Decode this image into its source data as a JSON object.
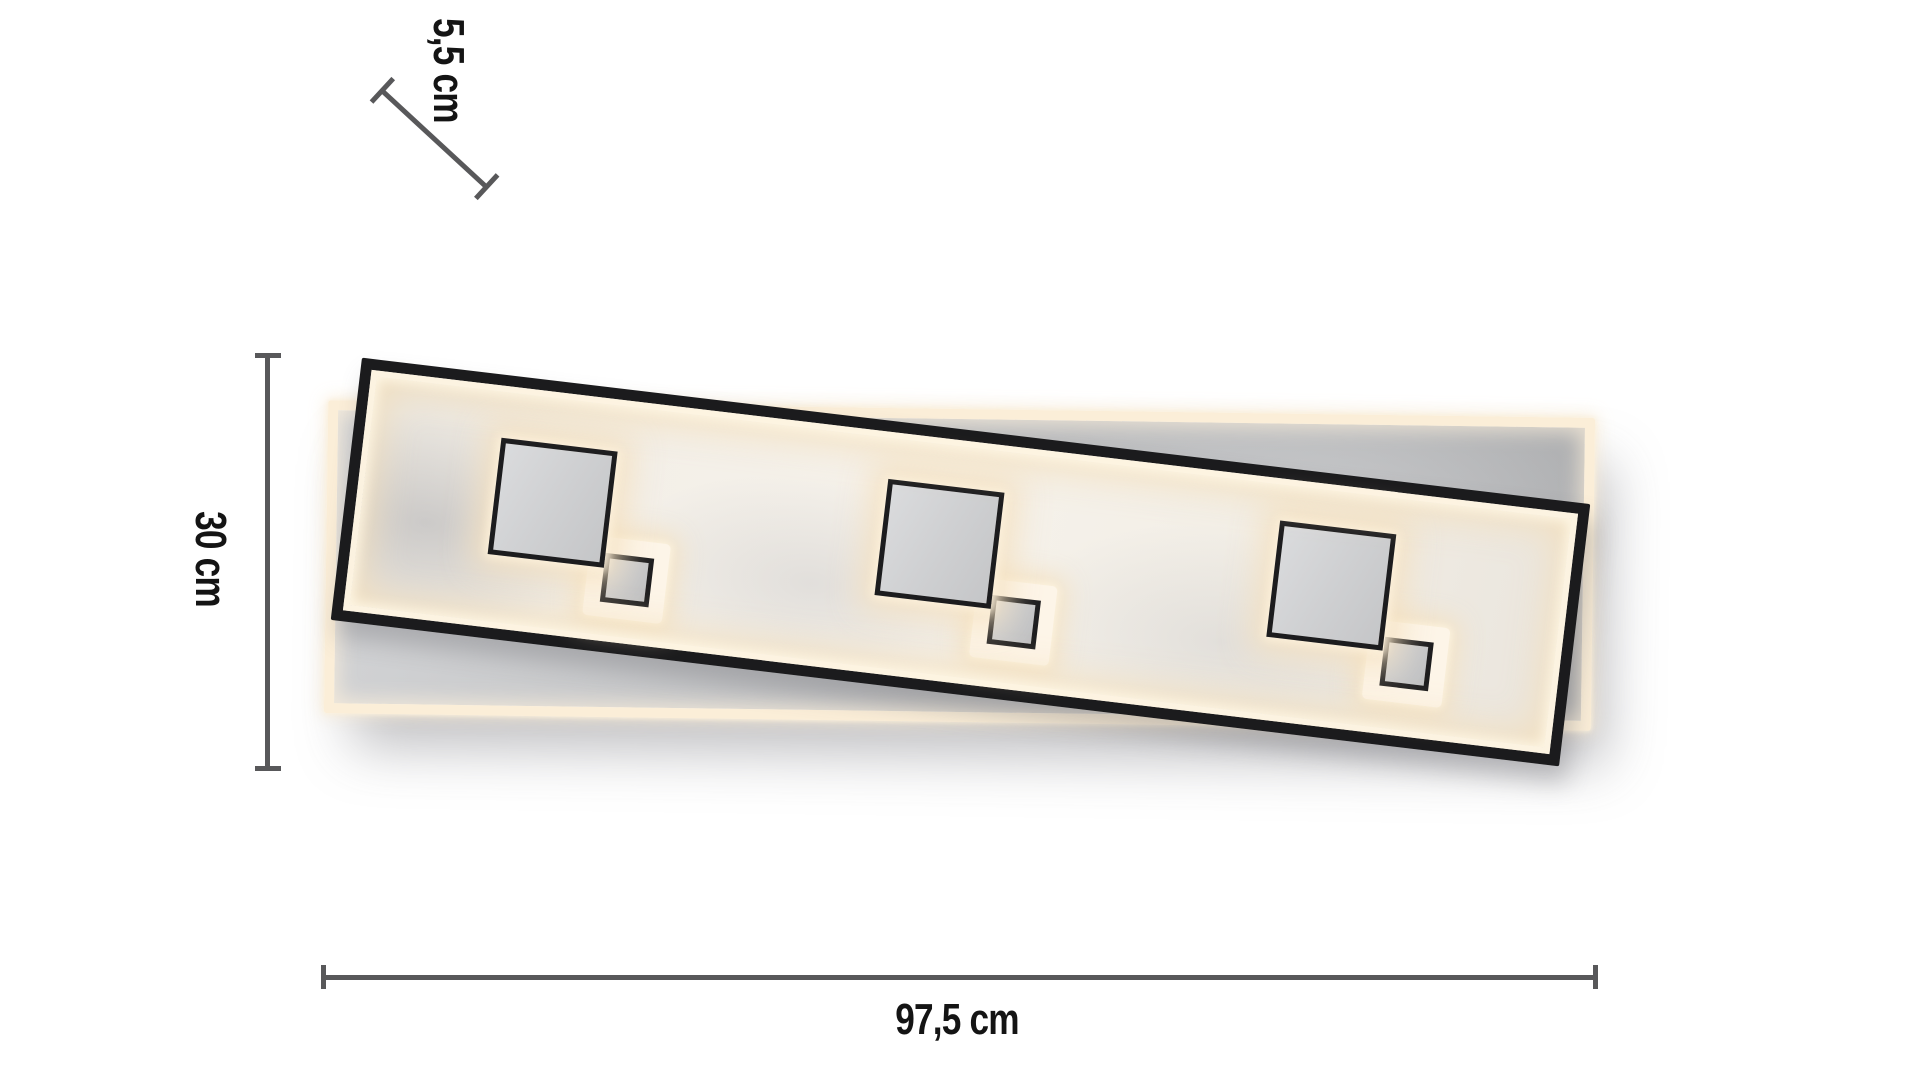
{
  "title": "Ceiling light product dimension diagram",
  "dimensions": {
    "width_label": "97,5 cm",
    "height_label": "30 cm",
    "depth_label": "5,5 cm"
  },
  "fixture": {
    "led_modules_count": 3,
    "elements": [
      "tilted black rectangular LED frame",
      "straight back panel",
      "3 large LED squares",
      "3 small LED squares"
    ]
  },
  "colors": {
    "background": "#ffffff",
    "frame_black": "#1b1b1d",
    "led_glow_bright": "#fdf3e0",
    "led_glow_soft": "#f6e3c2",
    "panel_gray": "#bbbcbe",
    "dimension_line": "#58585a",
    "label_text": "#141414"
  }
}
